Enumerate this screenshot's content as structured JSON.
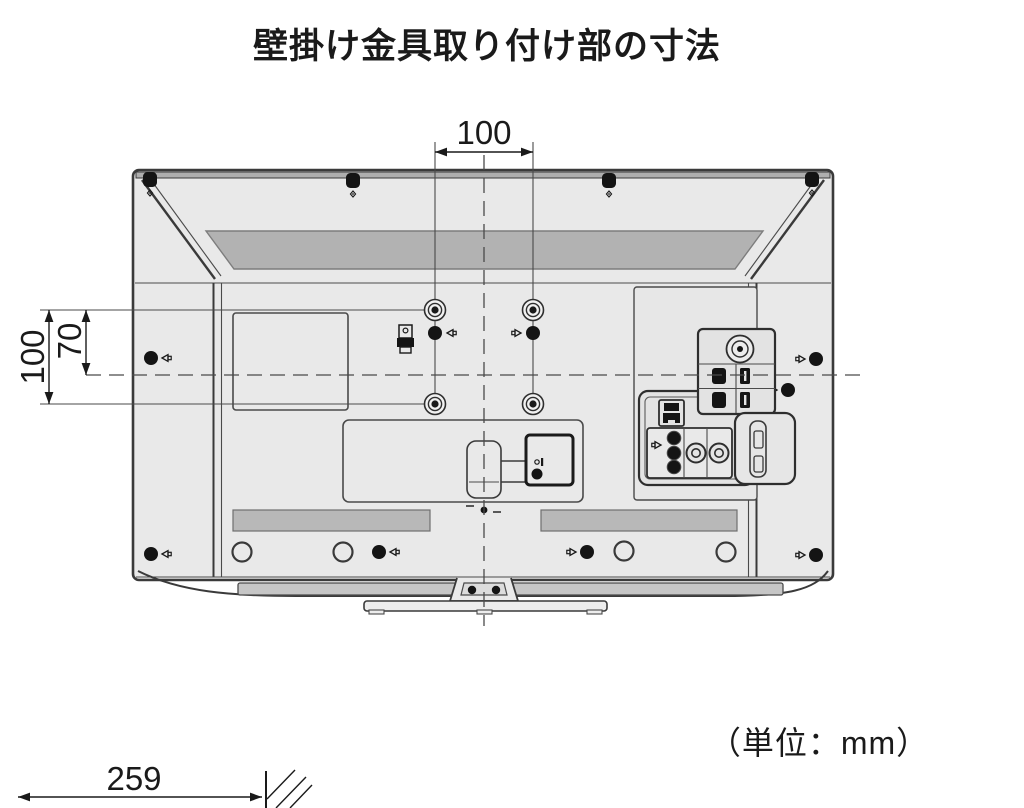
{
  "title": "壁掛け金具取り付け部の寸法",
  "unit_label": "（単位：mm）",
  "dimensions": {
    "mount_hole_width": "100",
    "mount_hole_height": "100",
    "center_offset": "70",
    "stand_depth": "259"
  },
  "diagram": {
    "type": "technical-drawing",
    "subject": "tv-rear-wall-mount-dimensions",
    "vesa_hole_count": 4,
    "colors": {
      "outline": "#3a3a3a",
      "body_fill": "#e9e9e9",
      "vent_fill": "#b2b2b2",
      "bezel_fill": "#c6c6c6",
      "text": "#1a1a1a"
    }
  }
}
